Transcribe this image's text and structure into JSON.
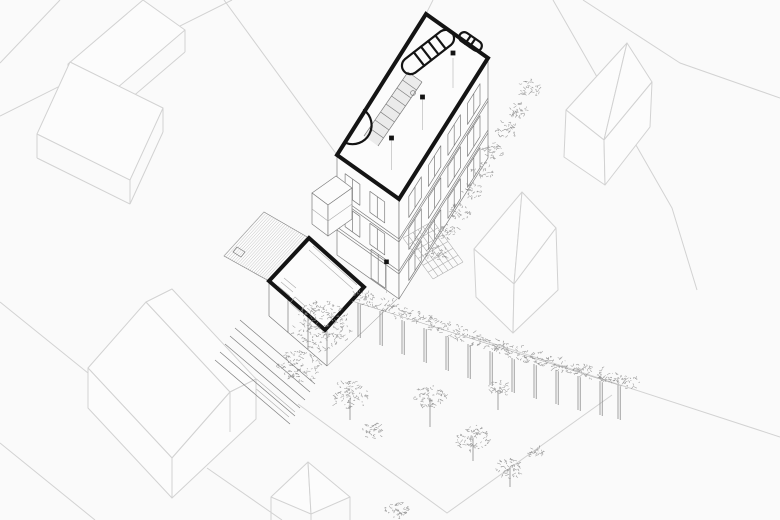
{
  "colors": {
    "background": "#fafafa",
    "context_line": "#d2d2d2",
    "building_line": "#7d7d7d",
    "detail_line": "#ababab",
    "plan_outline": "#141414",
    "foliage": "#8f8f8f",
    "hatch_line": "#bdbdbd",
    "surface_fill": "#fcfcfc",
    "floor_shading": "#e6e6e6"
  }
}
